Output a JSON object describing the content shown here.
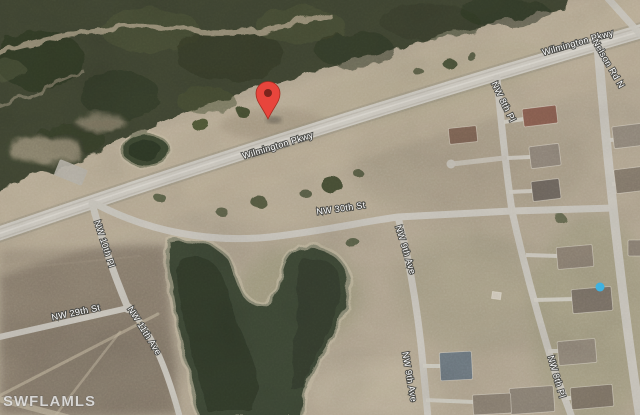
{
  "map": {
    "type": "satellite-aerial-view",
    "watermark": "SWFLAMLS",
    "marker": {
      "name": "red-location-pin",
      "color": "#e8453c",
      "dot_color": "#7b241c"
    },
    "street_labels": {
      "wilmington_center": "Wilmington Pkwy",
      "wilmington_ne": "Wilmington Pkwy",
      "nelson_rd": "Nelson Rd N",
      "nw_8th_pl_upper": "NW 8th Pl",
      "nw_8th_pl_lower": "NW 8th Pl",
      "nw_9th_ave_mid": "NW 9th Ave",
      "nw_9th_ave_lower": "NW 9th Ave",
      "nw_30th_st": "NW 30th St",
      "nw_10th_pl": "NW 10th Pl",
      "nw_29th_st": "NW 29th St",
      "nw_11th_ave": "NW 11th Ave"
    },
    "palette": {
      "ground_tan": "#b3a792",
      "cleared_strip": "#c2b59d",
      "field_brown": "#85796a",
      "vegetation_dark": "#3f4531",
      "water": "#3c4631",
      "road_gray": "#cdc9c0",
      "pool_blue": "#3fb6e8"
    }
  }
}
